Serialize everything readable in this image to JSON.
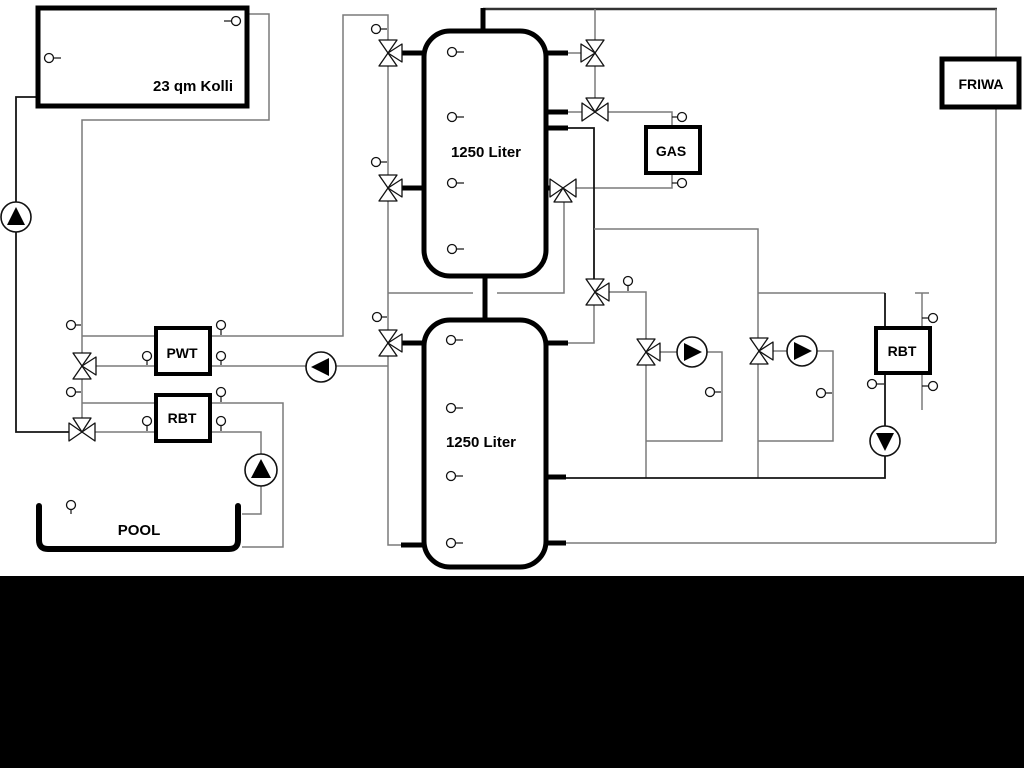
{
  "diagram": {
    "width": 1024,
    "height": 768,
    "background": "#ffffff",
    "band": {
      "top": 576,
      "height": 192,
      "color": "#000000"
    },
    "colors": {
      "pipe_gray": "#7a7a7a",
      "pipe_black": "#141414",
      "thick": "#000000",
      "top_line": "#333333",
      "symbol_stroke": "#111111",
      "symbol_fill": "#ffffff",
      "pump_triangle": "#000000"
    },
    "boxes": [
      {
        "id": "solar-collector",
        "label": "23 qm Kolli",
        "x": 38,
        "y": 8,
        "w": 209,
        "h": 98,
        "rx": 0,
        "sw": 5,
        "lx": 193,
        "ly": 91,
        "fs": 15
      },
      {
        "id": "buffer-tank-1",
        "label": "1250 Liter",
        "x": 424,
        "y": 31,
        "w": 122,
        "h": 245,
        "rx": 26,
        "sw": 5,
        "lx": 486,
        "ly": 157,
        "fs": 15
      },
      {
        "id": "buffer-tank-2",
        "label": "1250 Liter",
        "x": 424,
        "y": 320,
        "w": 122,
        "h": 247,
        "rx": 26,
        "sw": 5,
        "lx": 481,
        "ly": 447,
        "fs": 15
      },
      {
        "id": "gas-boiler",
        "label": "GAS",
        "x": 646,
        "y": 127,
        "w": 54,
        "h": 46,
        "rx": 0,
        "sw": 4,
        "lx": 671,
        "ly": 156,
        "fs": 14
      },
      {
        "id": "friwa-station",
        "label": "FRIWA",
        "x": 942,
        "y": 59,
        "w": 77,
        "h": 48,
        "rx": 0,
        "sw": 5,
        "lx": 981,
        "ly": 89,
        "fs": 14
      },
      {
        "id": "pwt-heat-exchanger",
        "label": "PWT",
        "x": 156,
        "y": 328,
        "w": 54,
        "h": 46,
        "rx": 0,
        "sw": 4,
        "lx": 182,
        "ly": 358,
        "fs": 14
      },
      {
        "id": "rbt-left",
        "label": "RBT",
        "x": 156,
        "y": 395,
        "w": 54,
        "h": 46,
        "rx": 0,
        "sw": 4,
        "lx": 182,
        "ly": 423,
        "fs": 14
      },
      {
        "id": "rbt-right",
        "label": "RBT",
        "x": 876,
        "y": 328,
        "w": 54,
        "h": 45,
        "rx": 0,
        "sw": 4,
        "lx": 902,
        "ly": 356,
        "fs": 14
      }
    ],
    "pool": {
      "id": "pool",
      "label": "POOL",
      "path": "M 39 506 L 39 540 Q 39 549 48 549 L 229 549 Q 238 549 238 540 L 238 506",
      "sw": 6,
      "lx": 139,
      "ly": 535,
      "fs": 15
    },
    "pipes": [
      {
        "cls": "m",
        "pts": [
          [
            483,
            9
          ],
          [
            997,
            9
          ]
        ]
      },
      {
        "cls": "g",
        "pts": [
          [
            247,
            14
          ],
          [
            269,
            14
          ],
          [
            269,
            120
          ],
          [
            82,
            120
          ],
          [
            82,
            353
          ]
        ]
      },
      {
        "cls": "g",
        "pts": [
          [
            82,
            379
          ],
          [
            82,
            418
          ]
        ]
      },
      {
        "cls": "g",
        "pts": [
          [
            82,
            336
          ],
          [
            156,
            336
          ]
        ]
      },
      {
        "cls": "g",
        "pts": [
          [
            96,
            366
          ],
          [
            156,
            366
          ]
        ]
      },
      {
        "cls": "g",
        "pts": [
          [
            82,
            403
          ],
          [
            156,
            403
          ]
        ]
      },
      {
        "cls": "g",
        "pts": [
          [
            95,
            432
          ],
          [
            156,
            432
          ]
        ]
      },
      {
        "cls": "g",
        "pts": [
          [
            210,
            336
          ],
          [
            343,
            336
          ],
          [
            343,
            15
          ],
          [
            388,
            15
          ],
          [
            388,
            40
          ]
        ]
      },
      {
        "cls": "g",
        "pts": [
          [
            388,
            66
          ],
          [
            388,
            175
          ]
        ]
      },
      {
        "cls": "g",
        "pts": [
          [
            388,
            201
          ],
          [
            388,
            330
          ]
        ]
      },
      {
        "cls": "g",
        "pts": [
          [
            388,
            356
          ],
          [
            388,
            545
          ],
          [
            401,
            545
          ]
        ]
      },
      {
        "cls": "g",
        "pts": [
          [
            210,
            366
          ],
          [
            306,
            366
          ]
        ]
      },
      {
        "cls": "g",
        "pts": [
          [
            336,
            366
          ],
          [
            388,
            366
          ]
        ]
      },
      {
        "cls": "g",
        "pts": [
          [
            210,
            403
          ],
          [
            283,
            403
          ],
          [
            283,
            547
          ],
          [
            242,
            547
          ]
        ]
      },
      {
        "cls": "g",
        "pts": [
          [
            210,
            432
          ],
          [
            261,
            432
          ],
          [
            261,
            454
          ]
        ]
      },
      {
        "cls": "g",
        "pts": [
          [
            261,
            486
          ],
          [
            261,
            514
          ],
          [
            242,
            514
          ]
        ]
      },
      {
        "cls": "b",
        "pts": [
          [
            38,
            97
          ],
          [
            16,
            97
          ],
          [
            16,
            432
          ],
          [
            69,
            432
          ]
        ]
      },
      {
        "cls": "g",
        "pts": [
          [
            568,
            53
          ],
          [
            581,
            53
          ]
        ]
      },
      {
        "cls": "g",
        "pts": [
          [
            595,
            9
          ],
          [
            595,
            40
          ]
        ]
      },
      {
        "cls": "g",
        "pts": [
          [
            595,
            66
          ],
          [
            595,
            98
          ]
        ]
      },
      {
        "cls": "g",
        "pts": [
          [
            568,
            112
          ],
          [
            582,
            112
          ]
        ]
      },
      {
        "cls": "g",
        "pts": [
          [
            608,
            112
          ],
          [
            672,
            112
          ],
          [
            672,
            127
          ]
        ]
      },
      {
        "cls": "g",
        "pts": [
          [
            672,
            173
          ],
          [
            672,
            188
          ],
          [
            576,
            188
          ]
        ]
      },
      {
        "cls": "g",
        "pts": [
          [
            564,
            202
          ],
          [
            564,
            293
          ],
          [
            497,
            293
          ]
        ]
      },
      {
        "cls": "g",
        "pts": [
          [
            473,
            293
          ],
          [
            388,
            293
          ]
        ]
      },
      {
        "cls": "b",
        "pts": [
          [
            568,
            128
          ],
          [
            594,
            128
          ],
          [
            594,
            279
          ]
        ]
      },
      {
        "cls": "g",
        "pts": [
          [
            609,
            292
          ],
          [
            646,
            292
          ],
          [
            646,
            339
          ]
        ]
      },
      {
        "cls": "g",
        "pts": [
          [
            594,
            305
          ],
          [
            594,
            343
          ],
          [
            568,
            343
          ]
        ]
      },
      {
        "cls": "g",
        "pts": [
          [
            594,
            229
          ],
          [
            758,
            229
          ],
          [
            758,
            338
          ]
        ]
      },
      {
        "cls": "g",
        "pts": [
          [
            758,
            293
          ],
          [
            885,
            293
          ]
        ]
      },
      {
        "cls": "g",
        "pts": [
          [
            660,
            352
          ],
          [
            677,
            352
          ]
        ]
      },
      {
        "cls": "g",
        "pts": [
          [
            707,
            352
          ],
          [
            722,
            352
          ],
          [
            722,
            441
          ],
          [
            646,
            441
          ]
        ]
      },
      {
        "cls": "g",
        "pts": [
          [
            646,
            365
          ],
          [
            646,
            478
          ]
        ]
      },
      {
        "cls": "g",
        "pts": [
          [
            773,
            351
          ],
          [
            787,
            351
          ]
        ]
      },
      {
        "cls": "g",
        "pts": [
          [
            817,
            351
          ],
          [
            833,
            351
          ],
          [
            833,
            441
          ],
          [
            758,
            441
          ]
        ]
      },
      {
        "cls": "g",
        "pts": [
          [
            758,
            364
          ],
          [
            758,
            478
          ]
        ]
      },
      {
        "cls": "b",
        "pts": [
          [
            565,
            478
          ],
          [
            885,
            478
          ],
          [
            885,
            456
          ]
        ]
      },
      {
        "cls": "b",
        "pts": [
          [
            885,
            293
          ],
          [
            885,
            328
          ]
        ]
      },
      {
        "cls": "b",
        "pts": [
          [
            885,
            373
          ],
          [
            885,
            426
          ]
        ]
      },
      {
        "cls": "g",
        "pts": [
          [
            922,
            293
          ],
          [
            922,
            410
          ]
        ]
      },
      {
        "cls": "g",
        "pts": [
          [
            915,
            293
          ],
          [
            929,
            293
          ]
        ]
      },
      {
        "cls": "g",
        "pts": [
          [
            996,
            9
          ],
          [
            996,
            543
          ]
        ]
      },
      {
        "cls": "g",
        "pts": [
          [
            996,
            543
          ],
          [
            565,
            543
          ]
        ]
      }
    ],
    "thick_stubs": [
      {
        "pts": [
          [
            483,
            31
          ],
          [
            483,
            8
          ]
        ]
      },
      {
        "pts": [
          [
            485,
            276
          ],
          [
            485,
            320
          ]
        ]
      },
      {
        "pts": [
          [
            424,
            53
          ],
          [
            402,
            53
          ]
        ]
      },
      {
        "pts": [
          [
            424,
            188
          ],
          [
            402,
            188
          ]
        ]
      },
      {
        "pts": [
          [
            546,
            53
          ],
          [
            568,
            53
          ]
        ]
      },
      {
        "pts": [
          [
            546,
            112
          ],
          [
            568,
            112
          ]
        ]
      },
      {
        "pts": [
          [
            546,
            128
          ],
          [
            568,
            128
          ]
        ]
      },
      {
        "pts": [
          [
            546,
            188
          ],
          [
            551,
            188
          ]
        ]
      },
      {
        "pts": [
          [
            424,
            343
          ],
          [
            402,
            343
          ]
        ]
      },
      {
        "pts": [
          [
            424,
            545
          ],
          [
            401,
            545
          ]
        ]
      },
      {
        "pts": [
          [
            546,
            343
          ],
          [
            568,
            343
          ]
        ]
      },
      {
        "pts": [
          [
            546,
            477
          ],
          [
            566,
            477
          ]
        ]
      },
      {
        "pts": [
          [
            546,
            543
          ],
          [
            566,
            543
          ]
        ]
      }
    ],
    "valves": [
      {
        "cx": 388,
        "cy": 53,
        "orient": "v",
        "branch": "right"
      },
      {
        "cx": 388,
        "cy": 188,
        "orient": "v",
        "branch": "right"
      },
      {
        "cx": 595,
        "cy": 53,
        "orient": "v",
        "branch": "left"
      },
      {
        "cx": 595,
        "cy": 112,
        "orient": "h",
        "branch": "top"
      },
      {
        "cx": 563,
        "cy": 188,
        "orient": "h",
        "branch": "bottom"
      },
      {
        "cx": 595,
        "cy": 292,
        "orient": "v",
        "branch": "right"
      },
      {
        "cx": 82,
        "cy": 366,
        "orient": "v",
        "branch": "right"
      },
      {
        "cx": 82,
        "cy": 432,
        "orient": "h",
        "branch": "top"
      },
      {
        "cx": 388,
        "cy": 343,
        "orient": "v",
        "branch": "right"
      },
      {
        "cx": 646,
        "cy": 352,
        "orient": "v",
        "branch": "right"
      },
      {
        "cx": 759,
        "cy": 351,
        "orient": "v",
        "branch": "right"
      }
    ],
    "pumps": [
      {
        "cx": 16,
        "cy": 217,
        "r": 15,
        "dir": "up"
      },
      {
        "cx": 321,
        "cy": 367,
        "r": 15,
        "dir": "left"
      },
      {
        "cx": 261,
        "cy": 470,
        "r": 16,
        "dir": "up"
      },
      {
        "cx": 692,
        "cy": 352,
        "r": 15,
        "dir": "right"
      },
      {
        "cx": 802,
        "cy": 351,
        "r": 15,
        "dir": "right"
      },
      {
        "cx": 885,
        "cy": 441,
        "r": 15,
        "dir": "down"
      }
    ],
    "sensors": [
      {
        "cx": 236,
        "cy": 21,
        "ax": 224,
        "ay": 21
      },
      {
        "cx": 49,
        "cy": 58,
        "ax": 61,
        "ay": 58
      },
      {
        "cx": 452,
        "cy": 52,
        "ax": 464,
        "ay": 52
      },
      {
        "cx": 452,
        "cy": 117,
        "ax": 464,
        "ay": 117
      },
      {
        "cx": 452,
        "cy": 183,
        "ax": 464,
        "ay": 183
      },
      {
        "cx": 452,
        "cy": 249,
        "ax": 464,
        "ay": 249
      },
      {
        "cx": 451,
        "cy": 340,
        "ax": 463,
        "ay": 340
      },
      {
        "cx": 451,
        "cy": 408,
        "ax": 463,
        "ay": 408
      },
      {
        "cx": 451,
        "cy": 476,
        "ax": 463,
        "ay": 476
      },
      {
        "cx": 451,
        "cy": 543,
        "ax": 463,
        "ay": 543
      },
      {
        "cx": 71,
        "cy": 325,
        "ax": 81,
        "ay": 325
      },
      {
        "cx": 71,
        "cy": 392,
        "ax": 81,
        "ay": 392
      },
      {
        "cx": 147,
        "cy": 356,
        "ax": 147,
        "ay": 365
      },
      {
        "cx": 147,
        "cy": 421,
        "ax": 147,
        "ay": 431
      },
      {
        "cx": 221,
        "cy": 325,
        "ax": 221,
        "ay": 335
      },
      {
        "cx": 221,
        "cy": 356,
        "ax": 221,
        "ay": 365
      },
      {
        "cx": 221,
        "cy": 392,
        "ax": 221,
        "ay": 402
      },
      {
        "cx": 221,
        "cy": 421,
        "ax": 221,
        "ay": 431
      },
      {
        "cx": 71,
        "cy": 505,
        "ax": 71,
        "ay": 514
      },
      {
        "cx": 376,
        "cy": 29,
        "ax": 387,
        "ay": 29
      },
      {
        "cx": 376,
        "cy": 162,
        "ax": 387,
        "ay": 162
      },
      {
        "cx": 377,
        "cy": 317,
        "ax": 387,
        "ay": 317
      },
      {
        "cx": 628,
        "cy": 281,
        "ax": 628,
        "ay": 291
      },
      {
        "cx": 682,
        "cy": 117,
        "ax": 672,
        "ay": 117
      },
      {
        "cx": 682,
        "cy": 183,
        "ax": 672,
        "ay": 183
      },
      {
        "cx": 710,
        "cy": 392,
        "ax": 721,
        "ay": 392
      },
      {
        "cx": 821,
        "cy": 393,
        "ax": 832,
        "ay": 393
      },
      {
        "cx": 872,
        "cy": 384,
        "ax": 884,
        "ay": 384
      },
      {
        "cx": 933,
        "cy": 318,
        "ax": 922,
        "ay": 318
      },
      {
        "cx": 933,
        "cy": 386,
        "ax": 922,
        "ay": 386
      }
    ]
  }
}
